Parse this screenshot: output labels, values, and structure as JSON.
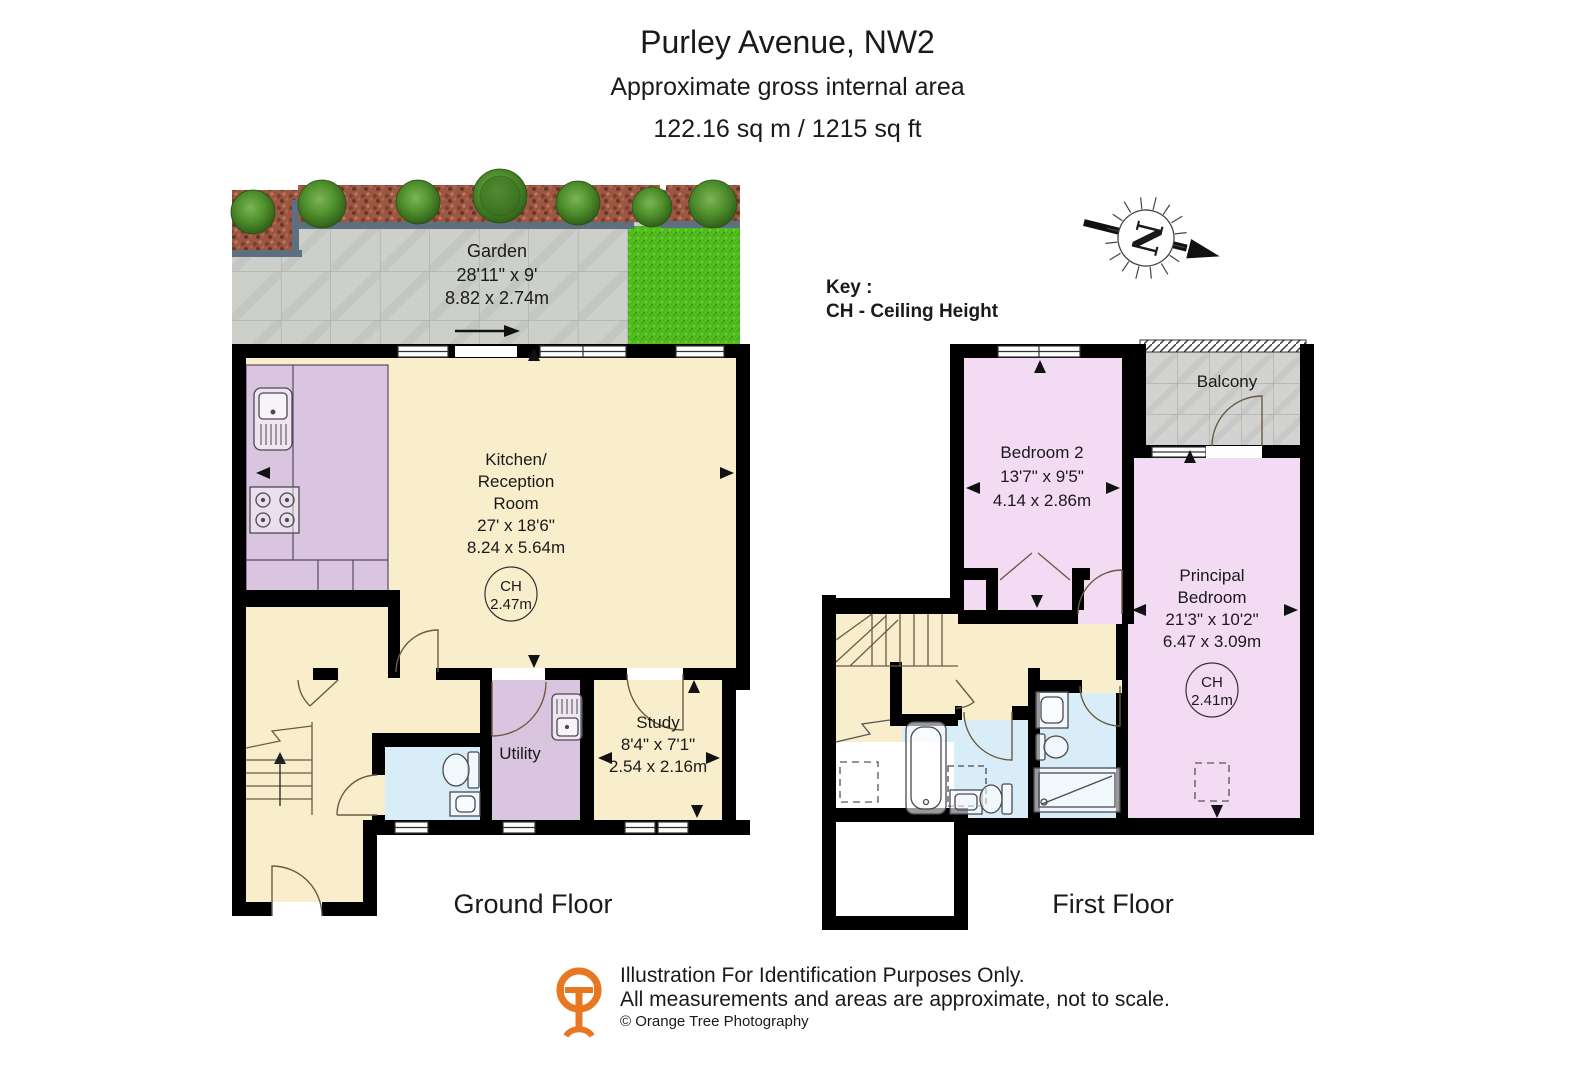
{
  "header": {
    "title": "Purley Avenue, NW2",
    "subtitle": "Approximate gross internal area",
    "area_line": "122.16 sq m / 1215 sq ft"
  },
  "key": {
    "label": "Key :",
    "entry": "CH - Ceiling Height"
  },
  "compass": {
    "letter": "N"
  },
  "garden": {
    "name": "Garden",
    "imperial": "28'11\" x 9'",
    "metric": "8.82 x 2.74m"
  },
  "ground_floor": {
    "label": "Ground Floor",
    "kitchen_reception": {
      "line1": "Kitchen/",
      "line2": "Reception",
      "line3": "Room",
      "imperial": "27' x 18'6\"",
      "metric": "8.24 x 5.64m",
      "ch_label": "CH",
      "ch_value": "2.47m"
    },
    "utility": {
      "name": "Utility"
    },
    "study": {
      "name": "Study",
      "imperial": "8'4\" x 7'1\"",
      "metric": "2.54 x 2.16m"
    }
  },
  "first_floor": {
    "label": "First Floor",
    "bedroom2": {
      "name": "Bedroom 2",
      "imperial": "13'7\" x 9'5\"",
      "metric": "4.14 x 2.86m"
    },
    "principal_bedroom": {
      "line1": "Principal",
      "line2": "Bedroom",
      "imperial": "21'3\" x 10'2\"",
      "metric": "6.47 x 3.09m",
      "ch_label": "CH",
      "ch_value": "2.41m"
    },
    "balcony": {
      "name": "Balcony"
    }
  },
  "footer": {
    "line1": "Illustration For Identification Purposes Only.",
    "line2": "All measurements and areas are approximate, not to scale.",
    "line3": "© Orange Tree Photography"
  },
  "colors": {
    "wall": "#000000",
    "room_cream": "#F8EECB",
    "room_pink": "#F3DBF3",
    "kitchen_purple": "#D9C5DF",
    "bathroom_blue": "#D9EDF8",
    "grass_green": "#52BB1F",
    "paving_grey": "#CCCFCA",
    "mulch_brown": "#9C5743",
    "edging_blue_grey": "#5C7080",
    "logo_orange": "#E87722"
  }
}
